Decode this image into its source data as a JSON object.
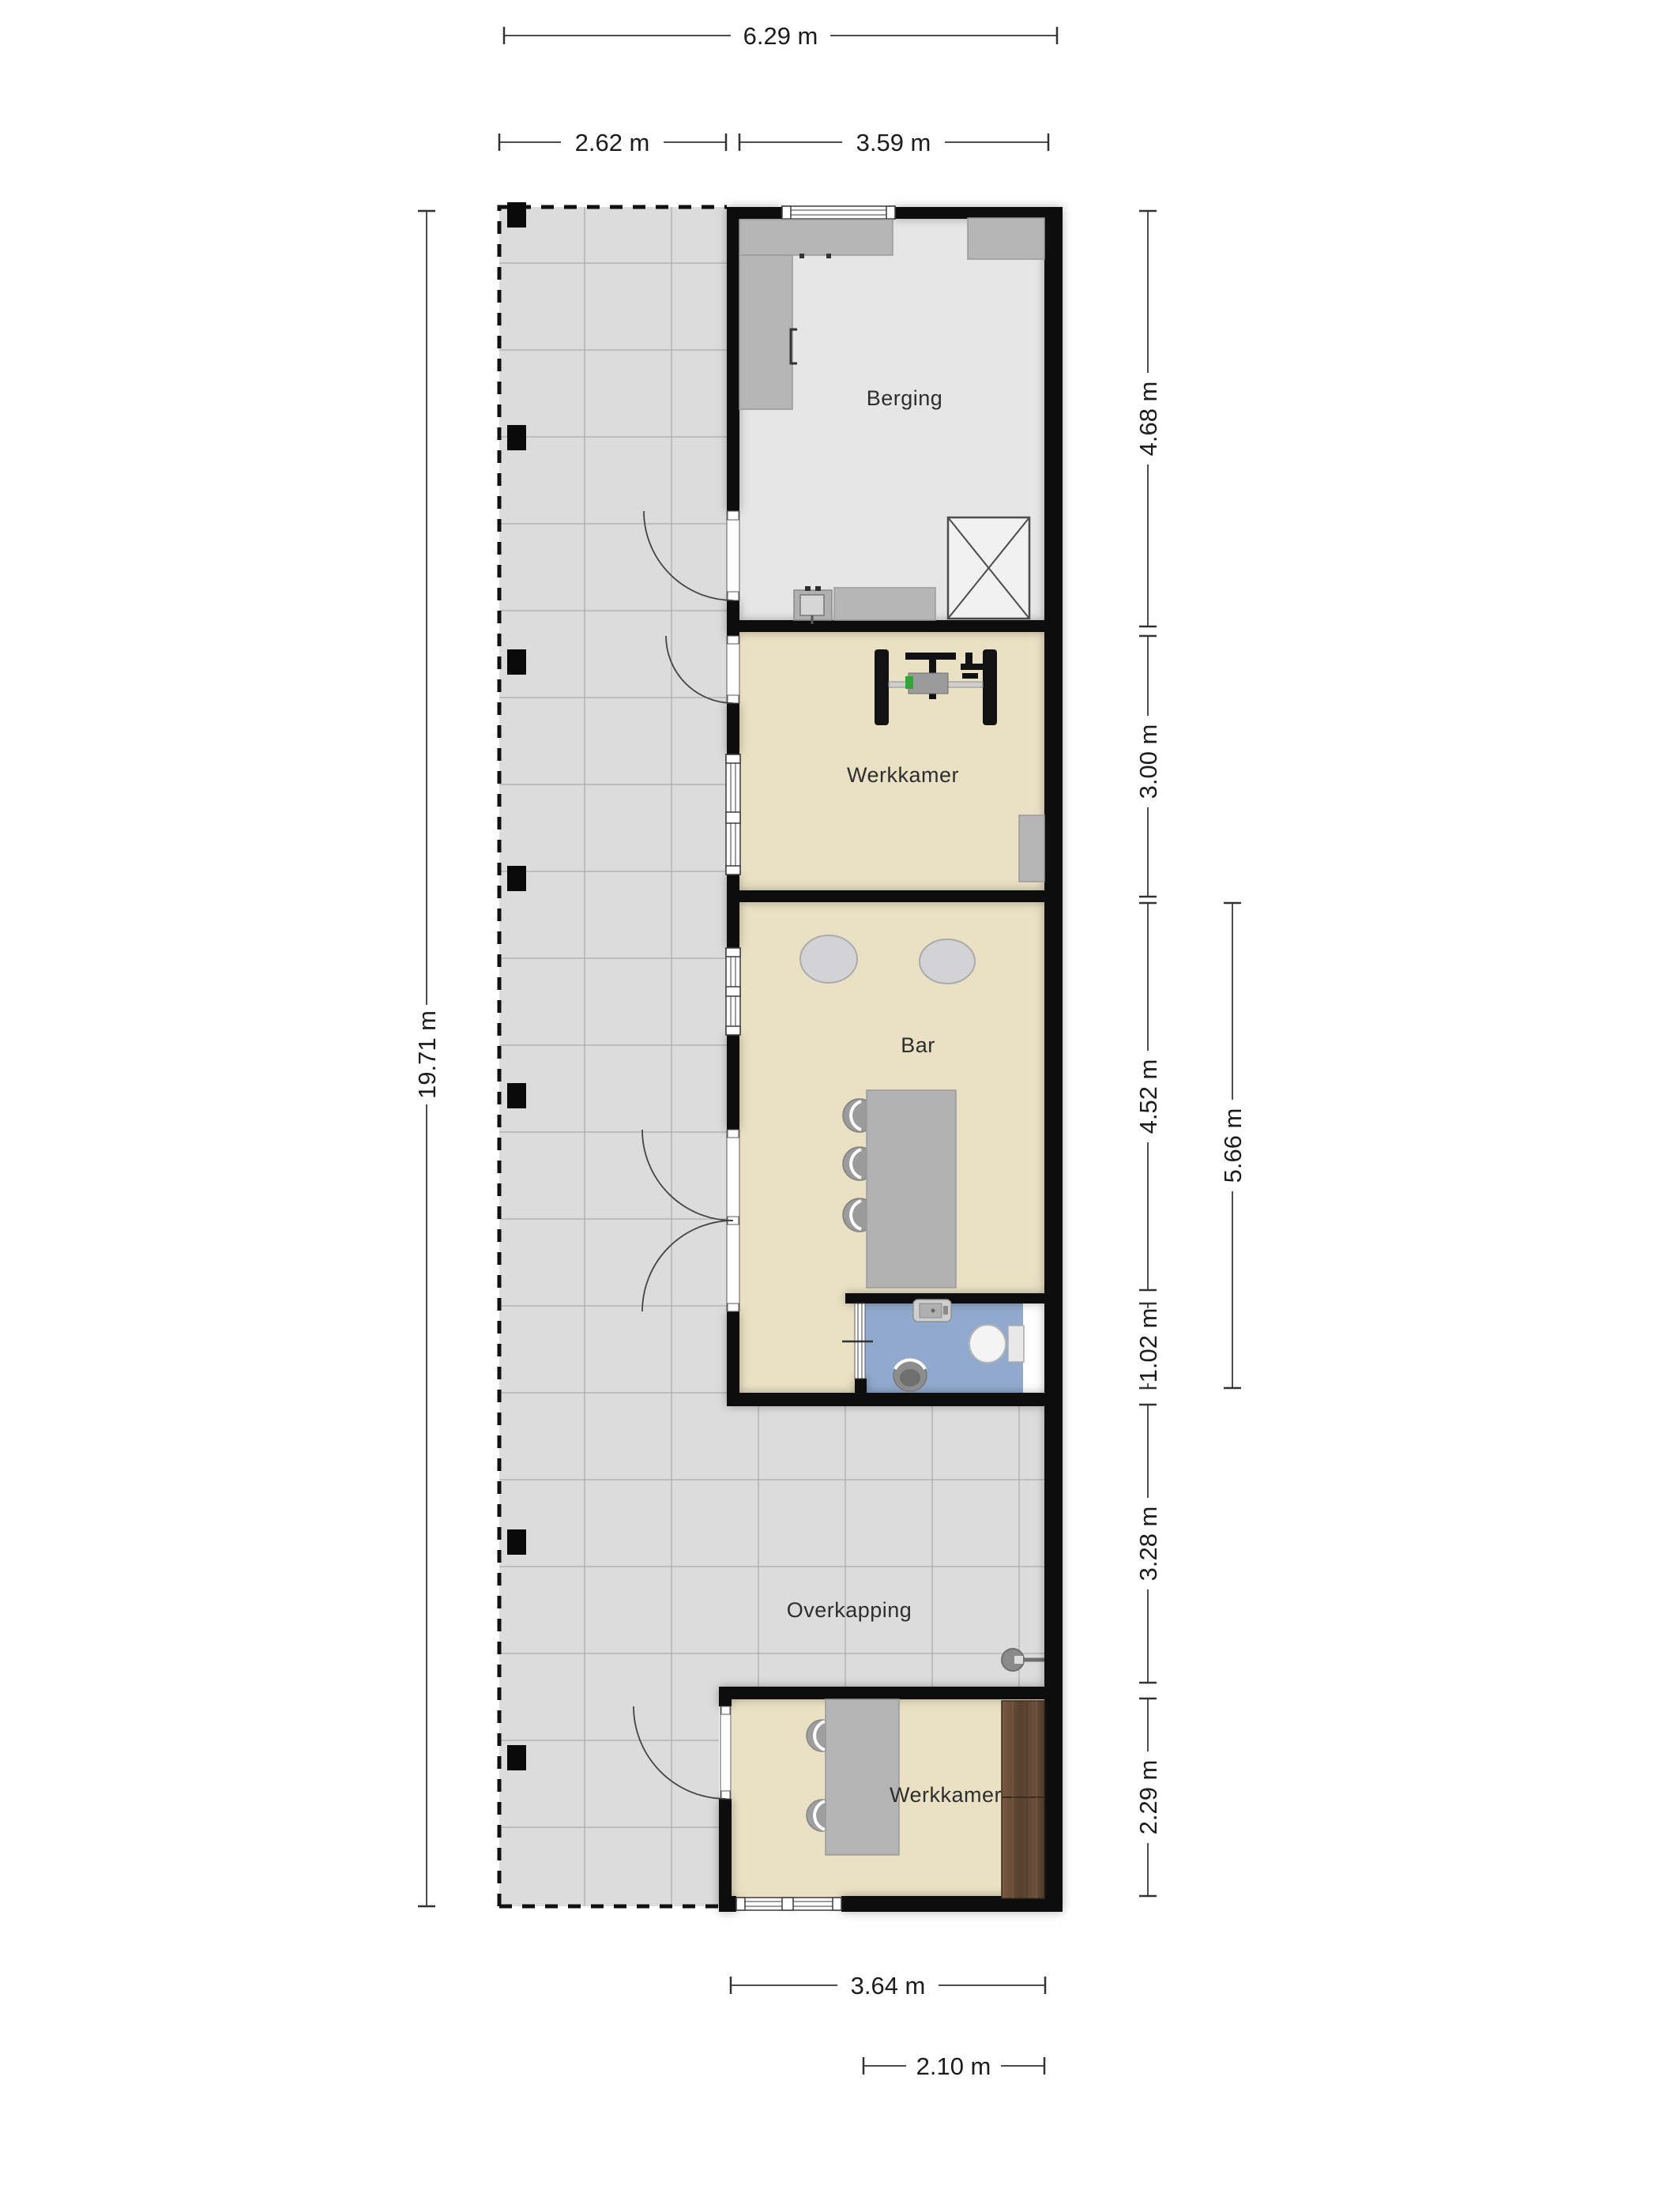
{
  "floorplan": {
    "rooms": {
      "berging": "Berging",
      "werkkamer_1": "Werkkamer",
      "bar": "Bar",
      "overkapping": "Overkapping",
      "werkkamer_2": "Werkkamer"
    },
    "dimensions": {
      "top_total": "6.29 m",
      "top_terrace": "2.62 m",
      "top_building": "3.59 m",
      "left_total": "19.71 m",
      "right_berging": "4.68 m",
      "right_werkkamer": "3.00 m",
      "right_bar": "4.52 m",
      "right_toilet": "1.02 m",
      "right_overkapping": "3.28 m",
      "right_werkkamer2": "2.29 m",
      "right_bar_toilet_total": "5.66 m",
      "bottom_werkkamer2": "3.64 m",
      "bottom_toilet": "2.10 m"
    },
    "colors": {
      "wall": "#070707",
      "terrace_tile": "#dcdcdc",
      "storage_floor": "#e6e6e6",
      "room_floor": "#eae1c5",
      "toilet_floor": "#91a9cd",
      "furniture_gray": "#b6b6b6",
      "wood_cabinet": "#5f4633"
    }
  }
}
